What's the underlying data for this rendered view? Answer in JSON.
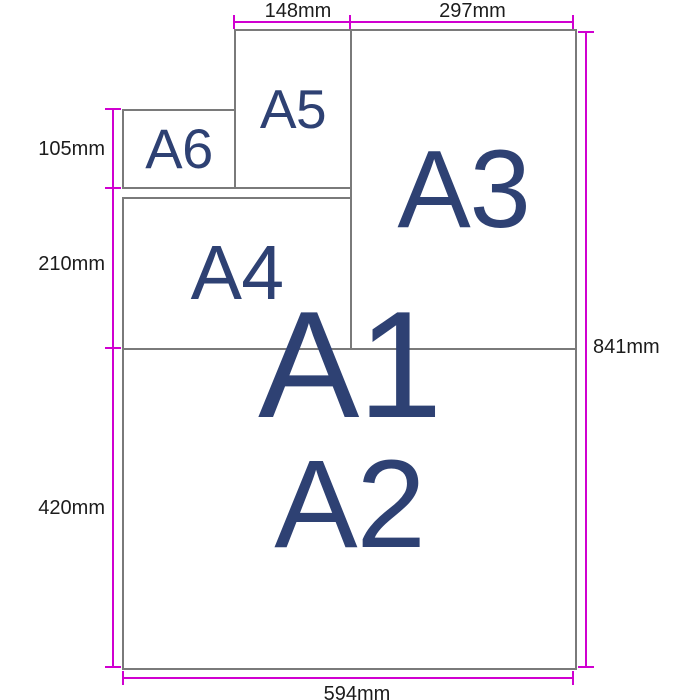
{
  "diagram": {
    "title": "A-series paper size comparison",
    "papers": {
      "a1": {
        "label": "A1"
      },
      "a2": {
        "label": "A2"
      },
      "a3": {
        "label": "A3"
      },
      "a4": {
        "label": "A4"
      },
      "a5": {
        "label": "A5"
      },
      "a6": {
        "label": "A6"
      }
    },
    "dimensions": {
      "a5_width": "148mm",
      "a3_width": "297mm",
      "a6_height": "105mm",
      "a4_height": "210mm",
      "a2_height": "420mm",
      "a1_height": "841mm",
      "a1_width": "594mm"
    },
    "colors": {
      "dimension_line": "#d000d0",
      "dimension_text": "#1c1c1c",
      "paper_border": "#7a7a7a",
      "paper_fill": "#ffffff",
      "paper_label": "#2e4173",
      "background": "#ffffff"
    }
  }
}
